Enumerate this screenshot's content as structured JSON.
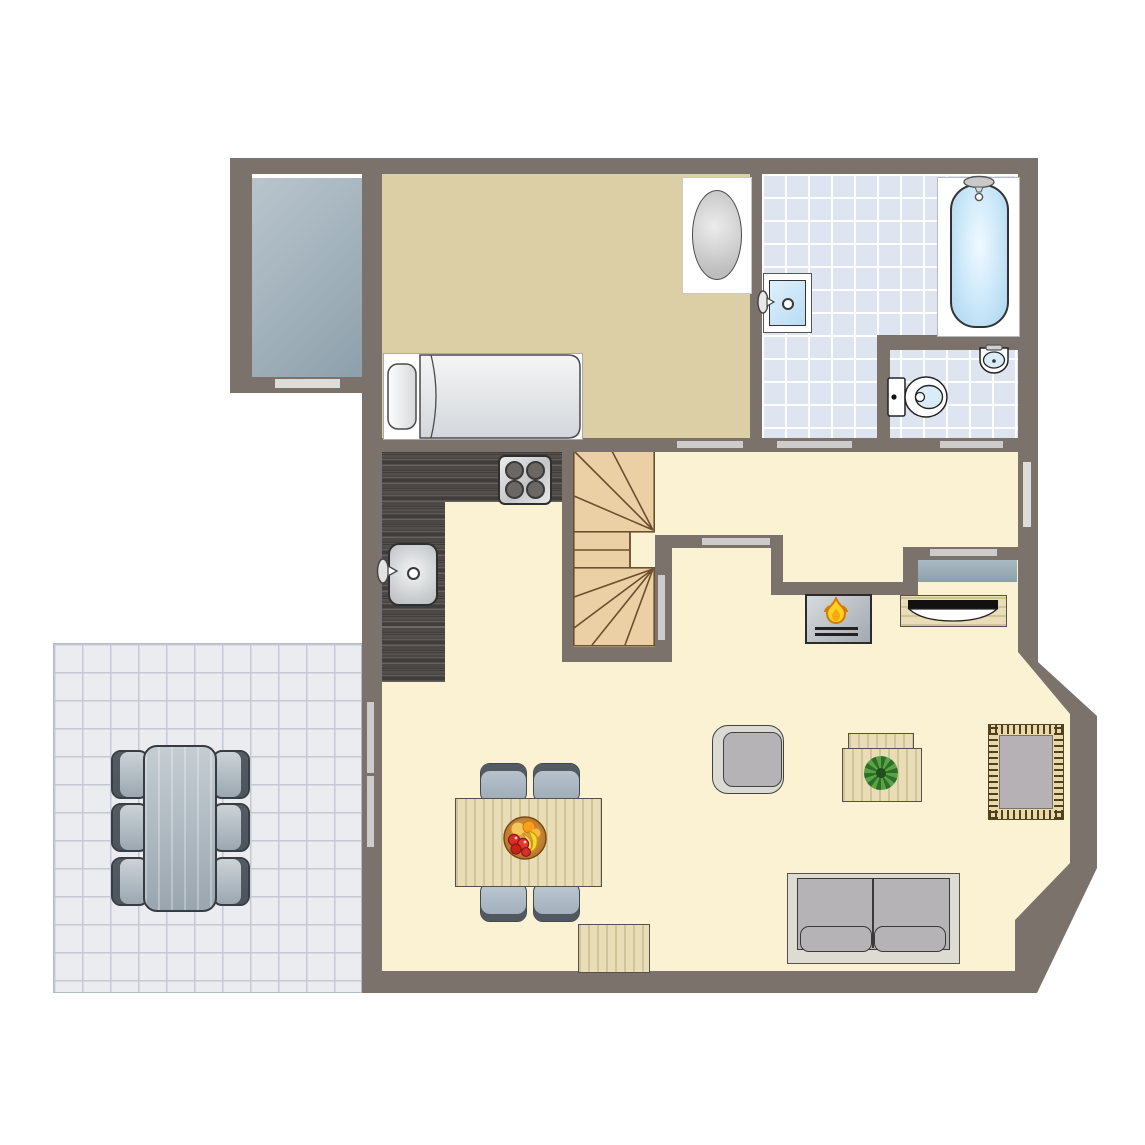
{
  "meta": {
    "type": "architectural-floor-plan",
    "view": "top-down ground floor",
    "visible_text": "none"
  },
  "colors": {
    "wall": "#7b726b",
    "floor_living": "#fbf1d3",
    "floor_bedroom": "#dccfa6",
    "tile_bath_bg": "#dfe5f0",
    "tile_patio_bg": "#eaecf0",
    "tile_patio_line": "#c4c9d1",
    "counter_dark": "#4c4846",
    "stair_wood": "#ecd0a5",
    "stair_line": "#6b4f2e",
    "door_bar": "#cdccca",
    "window_bar": "#dcdcd8",
    "wood_light": "#e8ddb6",
    "gray_furniture": "#b6b3b7",
    "light_frame": "#dbdad4",
    "sofa_base": "#dedcd2",
    "rug_center": "#b5b1b5",
    "rug_border": "#e7d9a9",
    "rug_dash": "#4f3f1d",
    "fire_yellow": "#ffd21f",
    "fire_orange": "#f08c00",
    "fixture_blue": "#cfe7f8"
  },
  "rooms": [
    {
      "id": "bedroom",
      "floor": "tan",
      "furniture": [
        "single-bed",
        "oval-top-cabinet"
      ]
    },
    {
      "id": "bathroom",
      "floor": "blue-tile",
      "fixtures": [
        "bathtub-with-shower",
        "wall-sink"
      ]
    },
    {
      "id": "wc",
      "floor": "blue-tile",
      "fixtures": [
        "toilet",
        "corner-sink"
      ]
    },
    {
      "id": "kitchen",
      "fixtures": [
        "l-shaped-counter",
        "stove-4-burners",
        "kitchen-sink"
      ]
    },
    {
      "id": "hallway",
      "features": [
        "closet-with-wardrobe"
      ]
    },
    {
      "id": "stairs",
      "style": "winder-staircase-two-fans"
    },
    {
      "id": "living-dining",
      "furniture": [
        "dining-table",
        "dining-chairs-4",
        "fruit-bowl",
        "armchair",
        "coffee-table",
        "plant",
        "rug",
        "sofa-2-seat",
        "bench",
        "fireplace",
        "tv-sideboard"
      ]
    },
    {
      "id": "balcony",
      "floor": "gray"
    },
    {
      "id": "terrace",
      "floor": "gray-tile",
      "furniture": [
        "outdoor-table",
        "outdoor-chairs-6"
      ]
    }
  ],
  "openings": {
    "doors": [
      "bedroom-door",
      "bathroom-door",
      "wc-door",
      "hallway-door",
      "closet-door",
      "stairwell-door",
      "terrace-double-door"
    ],
    "windows": [
      "balcony-window",
      "east-window"
    ]
  }
}
